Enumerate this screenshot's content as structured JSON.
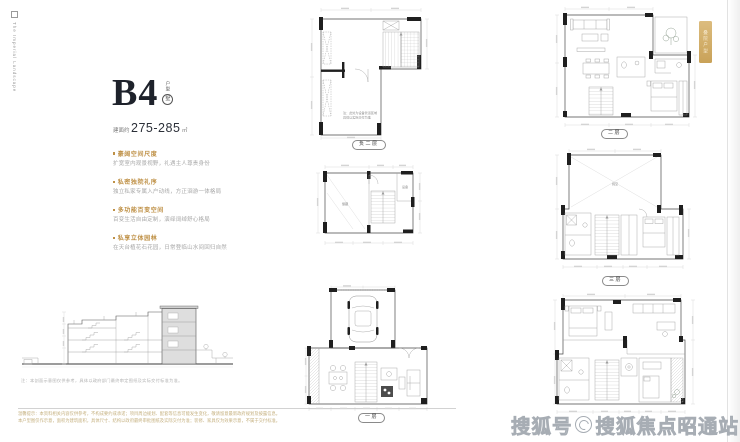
{
  "brand": {
    "text": "The Imperial Landscape"
  },
  "unit": {
    "name": "B4",
    "side_label": "户型",
    "seal": "墅",
    "area_prefix": "建面约",
    "area_value": "275-285",
    "area_unit": "㎡"
  },
  "features": [
    {
      "title": "豪阔空间尺度",
      "desc": "扩宽室内观景视野，礼遇主人尊贵身份"
    },
    {
      "title": "私密独院礼序",
      "desc": "独立私家专属入户动线，方正洄游一体格局"
    },
    {
      "title": "多功能百变空间",
      "desc": "百变生活自由定制，演绎阔绰舒心格局"
    },
    {
      "title": "私享立体园林",
      "desc": "在天台植花石花园，日常登临山水间回归自然"
    }
  ],
  "section": {
    "caption": "注：本剖面示意图仅供参考，具体以政府部门最终审定图纸及实际交付标准为准。"
  },
  "disclaimer": {
    "line1": "温馨提示：本资料相关内容仅供参考，不构成要约或承诺；项目周边规划、配套等信息可能发生变化，敬请留意最新政府规划及披露信息。",
    "line2": "本户型图仅作示意，面积为建筑面积，具体尺寸、结构以政府最终审批图纸及实际交付为准；装修、家具仅为效果示意，不属于交付标准。"
  },
  "plans": {
    "m1": {
      "label": "负二层",
      "note1": "注：此处为设备管道区域",
      "note2": "具体以实际交付为准"
    },
    "m2": {
      "room1": "储藏",
      "room2": "设备"
    },
    "m3": {
      "label": "一层"
    },
    "r1": {
      "label": "二层"
    },
    "r2": {
      "label": "三层",
      "room": "挑空"
    },
    "r3": {}
  },
  "badge": {
    "text": "叠院户型"
  },
  "watermark": {
    "prefix": "搜狐号",
    "suffix": "搜狐焦点昭通站"
  },
  "colors": {
    "accent_gold": "#bf9147",
    "badge_gold": "#d0a95f",
    "ink": "#1e222b",
    "watermark_gray": "#a7adb4"
  }
}
